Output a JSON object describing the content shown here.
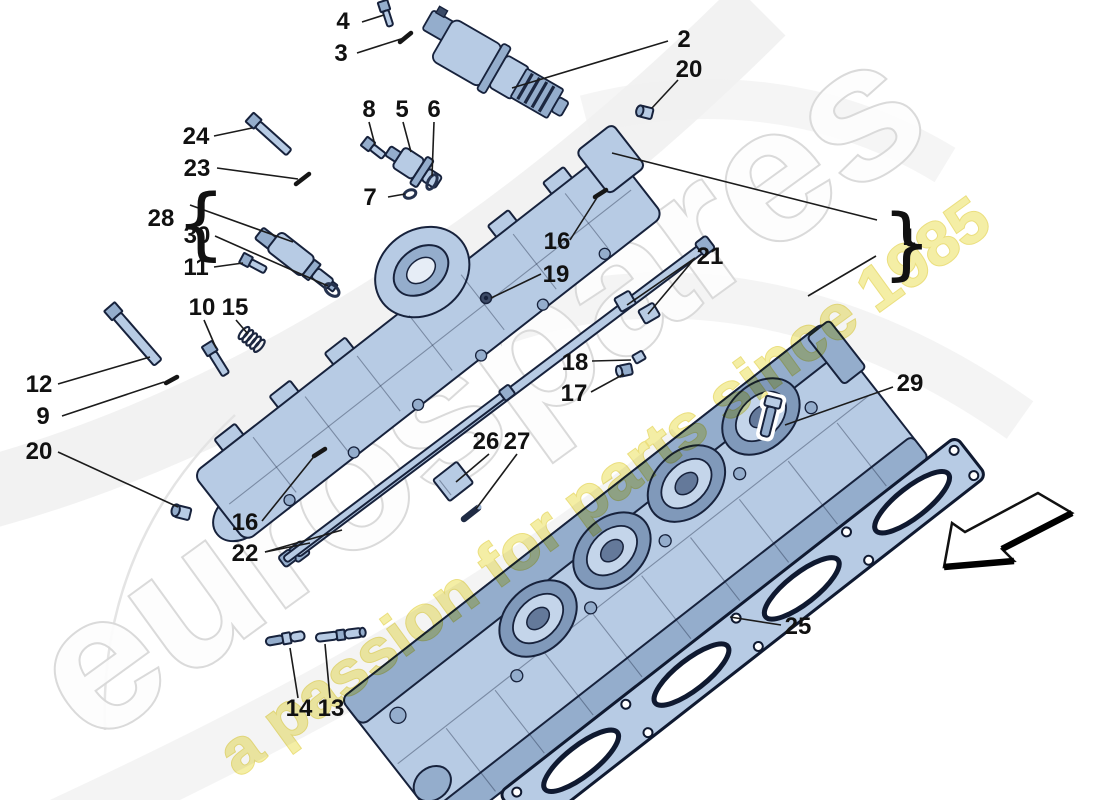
{
  "watermark": {
    "brand": "eurospares",
    "tagline": "a passion for parts since 1985"
  },
  "braces": {
    "left": "{",
    "right": "}"
  },
  "palette": {
    "background": "#ffffff",
    "part_fill": "#b7cbe4",
    "part_shade": "#94adcc",
    "part_dark": "#8099ba",
    "outline": "#17223c",
    "label_color": "#111111",
    "leader": "#1b1b1b",
    "watermark_fill": "#fdfdfd",
    "watermark_stroke": "#d9d9d9",
    "tagline_fill": "#f2ea8e",
    "tagline_stroke": "#e6d75f"
  },
  "callouts": {
    "n1": {
      "label": "1"
    },
    "n2": {
      "label": "2"
    },
    "n3": {
      "label": "3"
    },
    "n4": {
      "label": "4"
    },
    "n5": {
      "label": "5"
    },
    "n6": {
      "label": "6"
    },
    "n7": {
      "label": "7"
    },
    "n8": {
      "label": "8"
    },
    "n9": {
      "label": "9"
    },
    "n10": {
      "label": "10"
    },
    "n11": {
      "label": "11"
    },
    "n12": {
      "label": "12"
    },
    "n13": {
      "label": "13"
    },
    "n14": {
      "label": "14"
    },
    "n15": {
      "label": "15"
    },
    "n16a": {
      "label": "16"
    },
    "n16b": {
      "label": "16"
    },
    "n17": {
      "label": "17"
    },
    "n18": {
      "label": "18"
    },
    "n19": {
      "label": "19"
    },
    "n20a": {
      "label": "20"
    },
    "n20b": {
      "label": "20"
    },
    "n21": {
      "label": "21"
    },
    "n22": {
      "label": "22"
    },
    "n23": {
      "label": "23"
    },
    "n24": {
      "label": "24"
    },
    "n25": {
      "label": "25"
    },
    "n26": {
      "label": "26"
    },
    "n27": {
      "label": "27"
    },
    "n28": {
      "label": "28"
    },
    "n29": {
      "label": "29"
    },
    "n30": {
      "label": "30"
    }
  }
}
